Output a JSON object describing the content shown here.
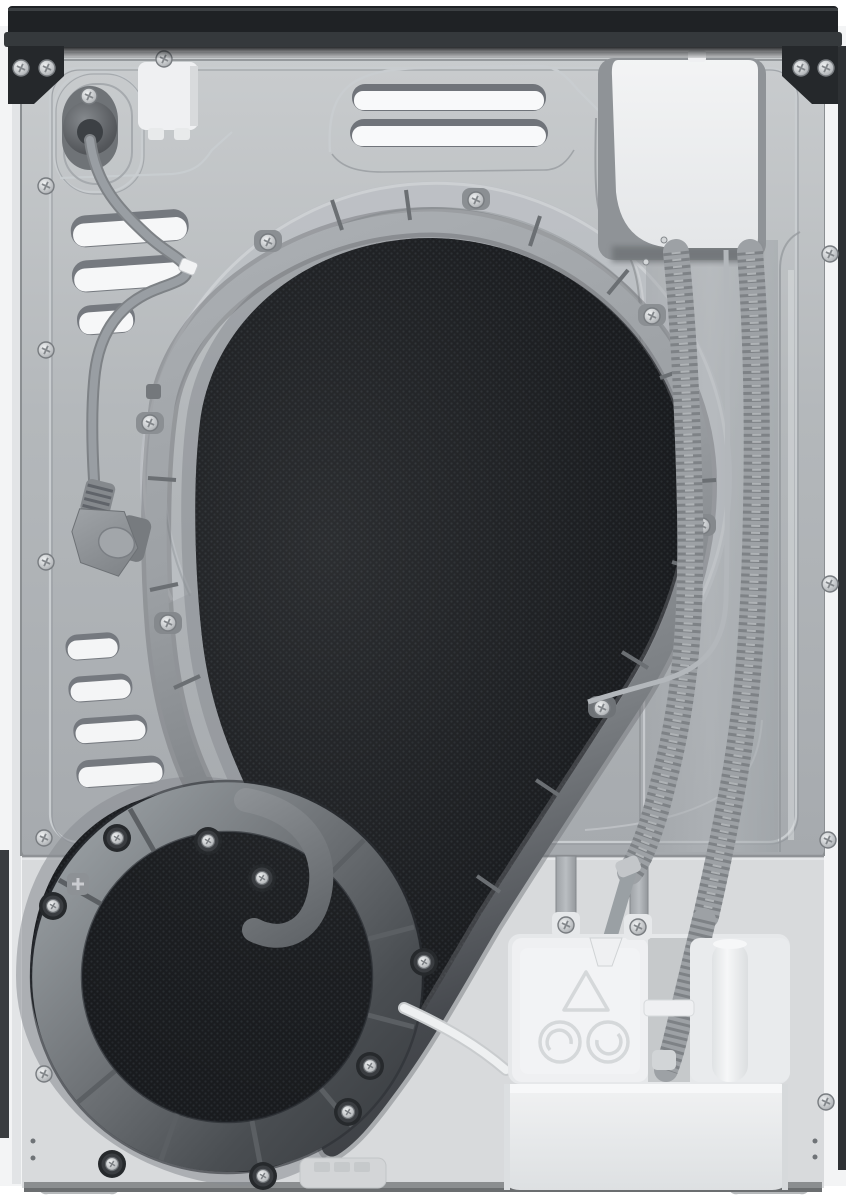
{
  "meta": {
    "label": "Tumble dryer rear panel — product photograph",
    "view": "back view, full appliance"
  },
  "colors": {
    "top_cap": "#1f2225",
    "cap_lip": "#35393c",
    "bracket": "#25282b",
    "side_panel": "#f3f4f5",
    "side_strip": "#e2e4e6",
    "seam": "#8b8f92",
    "edge_dark": "#2e3134",
    "metal": "#b3b7bb",
    "lower_panel": "#d8dadc",
    "mesh": "#17191c",
    "gasket_light": "#a9adb2",
    "ring_dark": "#4a4e53",
    "hose": "#9da1a5",
    "cord": "#999ea3",
    "white_plastic": "#eff0f2",
    "bucket": "#eceef0",
    "channel_recess": "#c6c9cb",
    "foot": "#ced1d3",
    "screw": "#c9ccd0",
    "emboss_light": "#c8cccf",
    "emboss_dark": "#92969a",
    "boss": "#26292c",
    "recess": "#8f9397",
    "white_hose": "#eef0f1"
  },
  "parts": {
    "machine": "Tumble dryer, rear view",
    "top_cap": "Top cover rear trim",
    "corner_bracket": "Black corner bracket",
    "side_panel": "Side panel edge",
    "back_panel": "Stamped sheet-metal back panel",
    "lower_panel": "Lower service panel",
    "drum_plate": "Black mesh drum/duct recess",
    "duct_gasket": "Process-air duct seal",
    "blower_ring": "Spiral blower duct ring",
    "spiral_hook": "Spiral duct inner hook",
    "power_inlet": "Mains cable inlet grommet",
    "junction_box": "White junction box",
    "power_cord": "Power supply cord",
    "power_plug": "Parked power plug",
    "cord_clip": "Cord retaining clip",
    "top_vents": "Top ventilation slots",
    "left_vents_upper": "Upper-left ventilation slots",
    "left_vents_lower": "Lower-left ventilation slots",
    "terminal_cover": "Top-right service cover",
    "hose_channel": "Hose routing channel",
    "drain_hose_inner": "Corrugated hose (inner)",
    "drain_hose_outer": "Corrugated hose (outer)",
    "sensor_cable": "Thin sensor cable",
    "condensate_unit": "Condensate pump unit",
    "condensate_bucket": "Condensate drawer",
    "funnel": "Hose funnel port",
    "water_tube": "White condensate tube",
    "warning_triangle": "Embossed warning triangle",
    "recycle_marks": "Embossed circular marks",
    "strap": "Mounting strap",
    "foot": "Leveling foot",
    "screw": "Phillips screw",
    "screw_boss": "Dark screw boss",
    "tick": "Seal rib tab",
    "emboss": "Stamped crease line",
    "tray_emboss": "Stamped tray mark",
    "pin": "Locating pin",
    "drain_dots": "Drain pinholes"
  },
  "counts": {
    "perimeter_screws": 13,
    "gasket_screws": 7,
    "ring_bosses": 8,
    "top_vent_slots": 2,
    "upper_left_vent_slots": 3,
    "lower_left_vent_slots": 4,
    "drain_hoses": 2,
    "feet": 2
  }
}
